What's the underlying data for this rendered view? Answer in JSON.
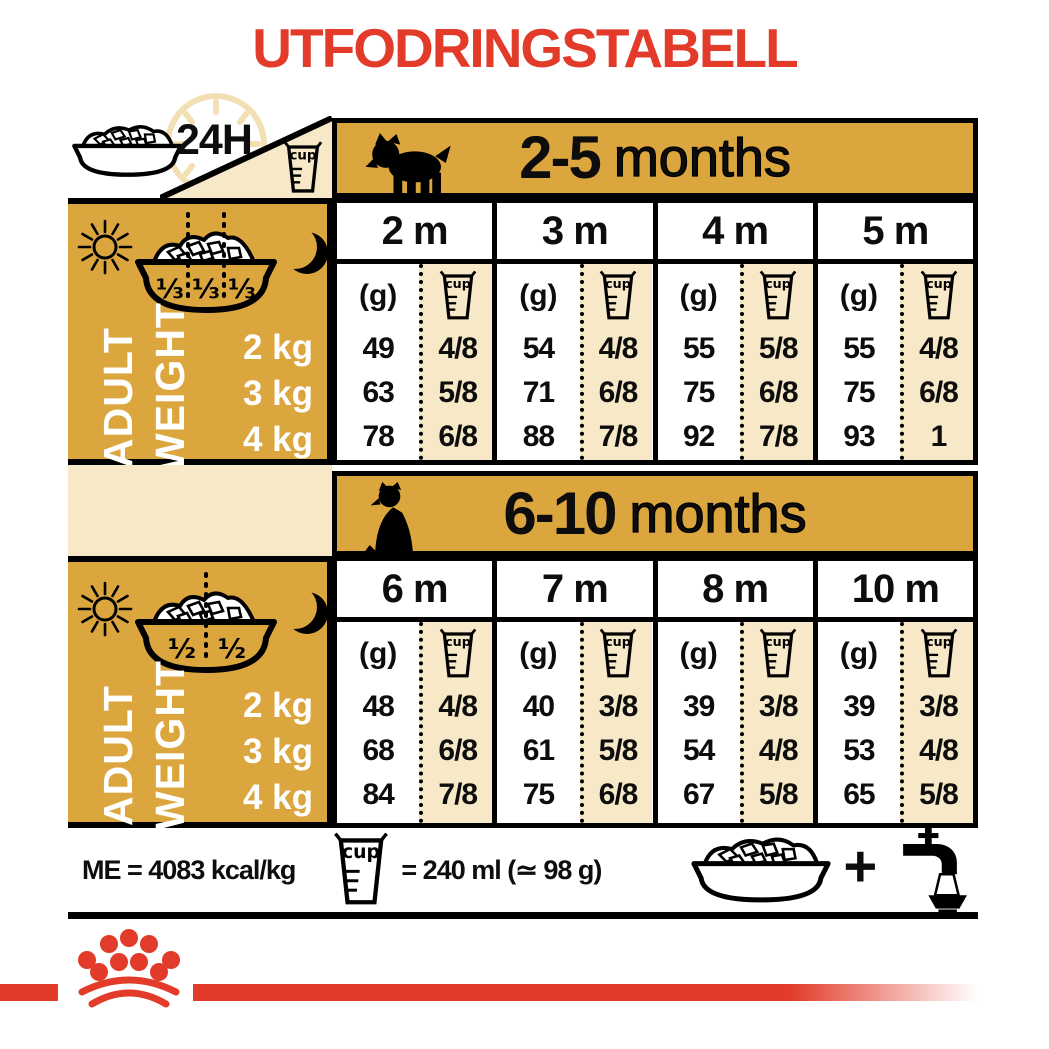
{
  "title": "UTFODRINGSTABELL",
  "labels": {
    "always": "24H",
    "cup": "cup",
    "gram": "(g)",
    "adult1": "ADULT",
    "adult2": "WEIGHT",
    "plus": "+"
  },
  "colors": {
    "gold": "#DCA63E",
    "cream": "#F7E9C8",
    "red": "#E23B2A",
    "black": "#0d0d0d"
  },
  "sections": [
    {
      "period_bold": "2-5",
      "period_rest": "months",
      "bowl_fractions": [
        "⅓",
        "⅓",
        "⅓"
      ],
      "weights": [
        "2 kg",
        "3 kg",
        "4 kg"
      ],
      "columns": [
        {
          "label": "2 m",
          "grams": [
            "49",
            "63",
            "78"
          ],
          "cups": [
            "4/8",
            "5/8",
            "6/8"
          ]
        },
        {
          "label": "3 m",
          "grams": [
            "54",
            "71",
            "88"
          ],
          "cups": [
            "4/8",
            "6/8",
            "7/8"
          ]
        },
        {
          "label": "4 m",
          "grams": [
            "55",
            "75",
            "92"
          ],
          "cups": [
            "5/8",
            "6/8",
            "7/8"
          ]
        },
        {
          "label": "5 m",
          "grams": [
            "55",
            "75",
            "93"
          ],
          "cups": [
            "4/8",
            "6/8",
            "1"
          ]
        }
      ]
    },
    {
      "period_bold": "6-10",
      "period_rest": "months",
      "bowl_fractions": [
        "½",
        "½"
      ],
      "weights": [
        "2 kg",
        "3 kg",
        "4 kg"
      ],
      "columns": [
        {
          "label": "6 m",
          "grams": [
            "48",
            "68",
            "84"
          ],
          "cups": [
            "4/8",
            "6/8",
            "7/8"
          ]
        },
        {
          "label": "7 m",
          "grams": [
            "40",
            "61",
            "75"
          ],
          "cups": [
            "3/8",
            "5/8",
            "6/8"
          ]
        },
        {
          "label": "8 m",
          "grams": [
            "39",
            "54",
            "67"
          ],
          "cups": [
            "3/8",
            "4/8",
            "5/8"
          ]
        },
        {
          "label": "10 m",
          "grams": [
            "39",
            "53",
            "65"
          ],
          "cups": [
            "3/8",
            "4/8",
            "5/8"
          ]
        }
      ]
    }
  ],
  "legend": {
    "me": "ME = 4083 kcal/kg",
    "cup_equiv": "= 240 ml (≃ 98 g)"
  }
}
